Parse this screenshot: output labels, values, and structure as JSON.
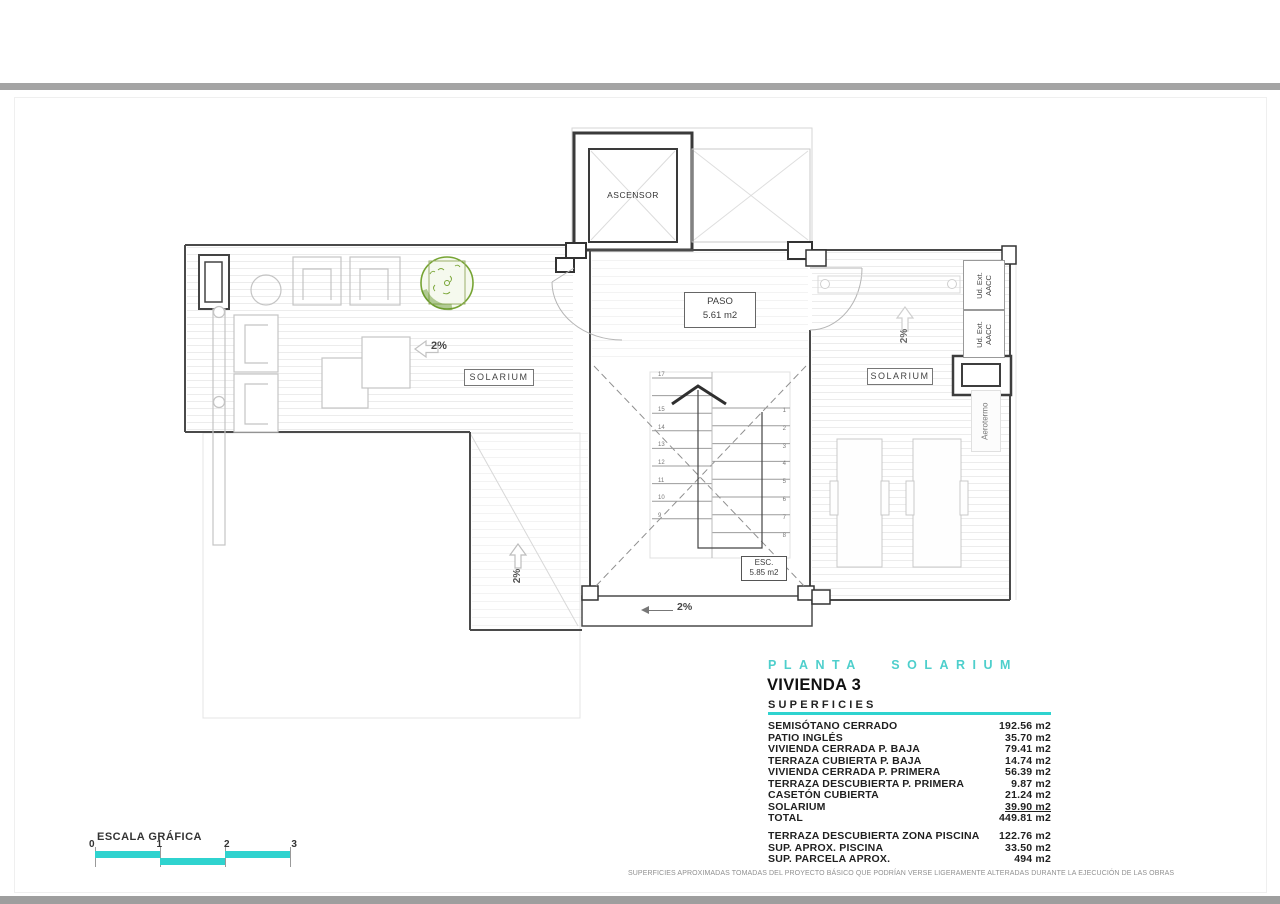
{
  "colors": {
    "accent": "#2fd3cf",
    "tree_green": "#76a433"
  },
  "plan": {
    "labels": {
      "elevator": "ASCENSOR",
      "paso": {
        "title": "PASO",
        "area": "5.61 m2"
      },
      "esc": {
        "title": "ESC.",
        "area": "5.85 m2"
      },
      "solarium_left": "SOLARIUM",
      "solarium_right": "SOLARIUM",
      "slope_left": "2%",
      "slope_bottom": "2%",
      "slope_vert_left": "2%",
      "slope_vert_right": "2%",
      "ud_ext": {
        "line1": "Ud. Ext.",
        "line2": "AACC"
      },
      "aerotermo": "Aerotermo"
    },
    "stairs": {
      "left_numbers": [
        "17",
        "",
        "15",
        "14",
        "13",
        "12",
        "11",
        "10",
        "9"
      ],
      "right_numbers": [
        "1",
        "2",
        "3",
        "4",
        "5",
        "6",
        "7",
        "8"
      ]
    }
  },
  "title_block": {
    "plan_title": "PLANTA SOLARIUM",
    "dwelling": "VIVIENDA 3",
    "section_heading": "SUPERFICIES",
    "rows": [
      {
        "label": "SEMISÓTANO CERRADO",
        "value": "192.56 m2"
      },
      {
        "label": "PATIO INGLÉS",
        "value": "35.70 m2"
      },
      {
        "label": "VIVIENDA CERRADA P. BAJA",
        "value": "79.41 m2"
      },
      {
        "label": "TERRAZA CUBIERTA P. BAJA",
        "value": "14.74 m2"
      },
      {
        "label": "VIVIENDA CERRADA P. PRIMERA",
        "value": "56.39 m2"
      },
      {
        "label": "TERRAZA DESCUBIERTA P. PRIMERA",
        "value": "9.87 m2"
      },
      {
        "label": "CASETÓN CUBIERTA",
        "value": "21.24 m2"
      },
      {
        "label": "SOLARIUM",
        "value": "39.90 m2",
        "underline": true
      },
      {
        "label": "TOTAL",
        "value": "449.81 m2"
      }
    ],
    "extra_rows": [
      {
        "label": "TERRAZA DESCUBIERTA ZONA PISCINA",
        "value": "122.76 m2"
      },
      {
        "label": "SUP. APROX. PISCINA",
        "value": "33.50 m2"
      },
      {
        "label": "SUP. PARCELA APROX.",
        "value": "494 m2"
      }
    ]
  },
  "scale_bar": {
    "title": "ESCALA GRÁFICA",
    "ticks": [
      "0",
      "1",
      "2",
      "3"
    ]
  },
  "disclaimer": "SUPERFICIES APROXIMADAS TOMADAS DEL PROYECTO BÁSICO QUE PODRÍAN VERSE LIGERAMENTE ALTERADAS DURANTE LA EJECUCIÓN DE LAS OBRAS"
}
